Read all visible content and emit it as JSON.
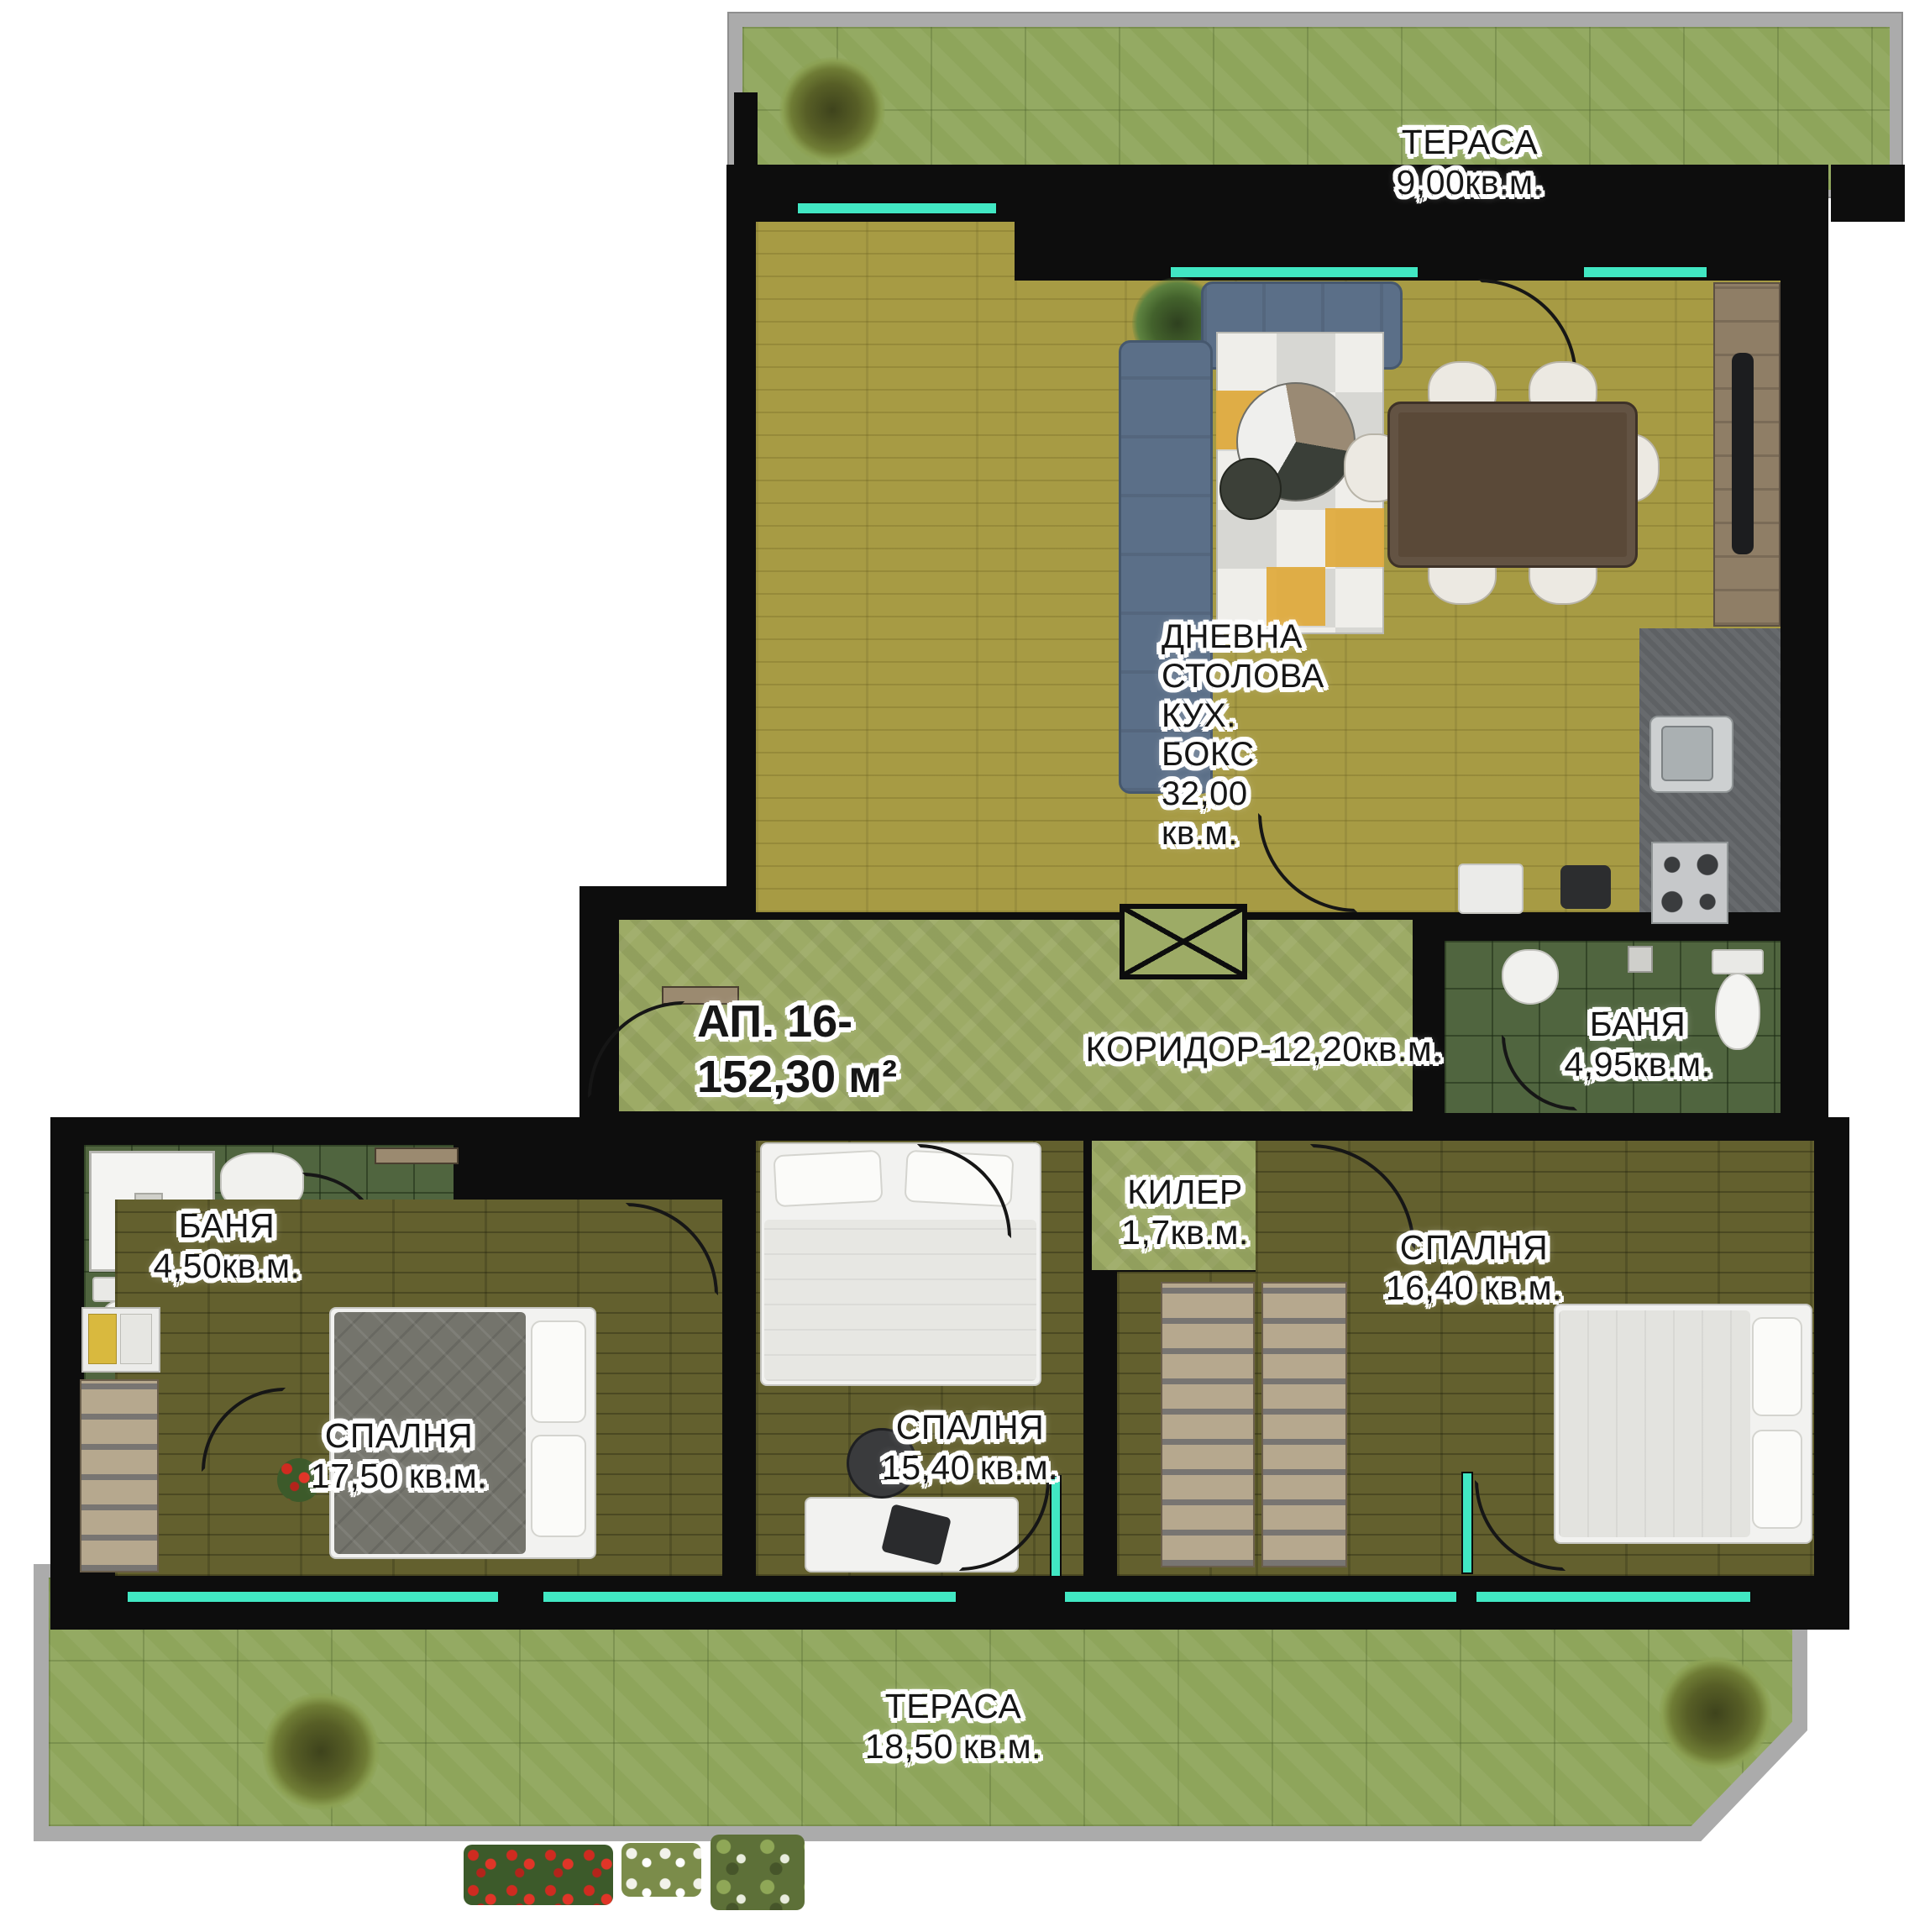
{
  "apartment": {
    "line1": "АП. 16-",
    "line2": "152,30 м²"
  },
  "rooms": {
    "terrace_top": {
      "name": "ТЕРАСА",
      "area": "9,00кв.м."
    },
    "living": {
      "line1": "ДНЕВНА",
      "line2": "СТОЛОВА",
      "line3": "КУХ.",
      "line4": "БОКС",
      "line5": "32,00",
      "line6": "кв.м."
    },
    "corridor": {
      "label": "КОРИДОР-12,20кв.м."
    },
    "bath_right": {
      "name": "БАНЯ",
      "area": "4,95кв.м."
    },
    "storage": {
      "name": "КИЛЕР",
      "area": "1,7кв.м."
    },
    "bedroom_right": {
      "name": "СПАЛНЯ",
      "area": "16,40 кв.м."
    },
    "bath_left": {
      "name": "БАНЯ",
      "area": "4,50кв.м."
    },
    "bedroom_left": {
      "name": "СПАЛНЯ",
      "area": "17,50 кв.м."
    },
    "bedroom_middle": {
      "name": "СПАЛНЯ",
      "area": "15,40 кв.м."
    },
    "terrace_bottom": {
      "name": "ТЕРАСА",
      "area": "18,50 кв.м."
    }
  },
  "colors": {
    "wall": "#0d0d0d",
    "window_glass": "#41e7c3",
    "terrace_tile": "#8ea55b",
    "living_floor": "#a79b44",
    "bedroom_floor": "#63602e",
    "corridor_floor": "#9dab66",
    "bath_tile": "#50653f",
    "kitchen_counter": "#5e6164",
    "parapet": "#ababab",
    "sofa": "#5b6f88",
    "rug_accent": "#dfa93a"
  }
}
